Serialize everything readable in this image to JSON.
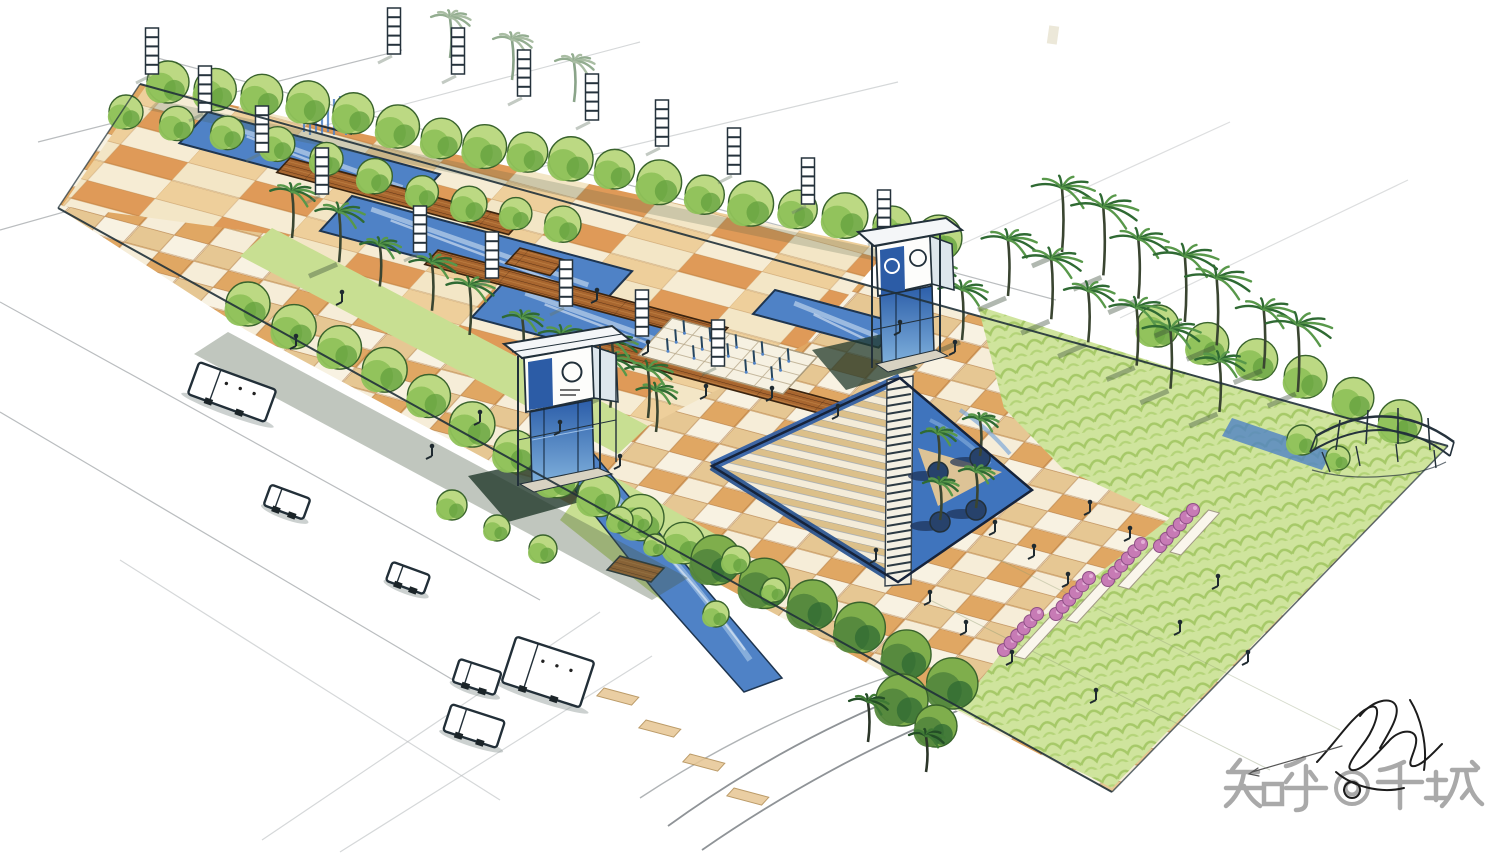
{
  "watermark": {
    "text": "知乎 @千城"
  },
  "signature": {
    "description": "artist signature (illegible ink scribble)"
  },
  "scene": {
    "description": "Bird's-eye hand-drawn marker rendering of a long rectangular urban plaza",
    "features": [
      "zigzag reflecting pools with fountain cascade",
      "timber deck bridges",
      "banded light columns",
      "checkerboard tan-orange paving",
      "fountain jet court",
      "two glass gateway pavilions with circular logos",
      "sunken triangular water plaza with central staircase and palm planters",
      "palm tree groves",
      "perimeter tree rows",
      "pink flower bed strips",
      "scallop-textured lawn",
      "arched trellis at far corner",
      "perimeter roads with sketched cars and buses"
    ]
  },
  "colors": {
    "paper": "#ffffff",
    "ink": "#22303a",
    "pencil": "#a9adb0",
    "water": "#4f82c6",
    "waterLight": "#9fc0e4",
    "waterDark": "#2c5ca6",
    "wood": "#a8662f",
    "woodDark": "#5f3416",
    "orange": "#d2703a",
    "orangeLight": "#e0a763",
    "sand": "#e6c793",
    "tan": "#eecf9b",
    "tanLight": "#f6edd8",
    "cream": "#f6f1e2",
    "treeGreen": "#8fc25a",
    "treeLight": "#bcd983",
    "treeDark": "#2f6a33",
    "lawn": "#cfe49d",
    "lawnShade": "#a3c765",
    "pink": "#c77bb5",
    "shadow": "#4a5d45",
    "watermarkGray": "#9b9b9b"
  }
}
